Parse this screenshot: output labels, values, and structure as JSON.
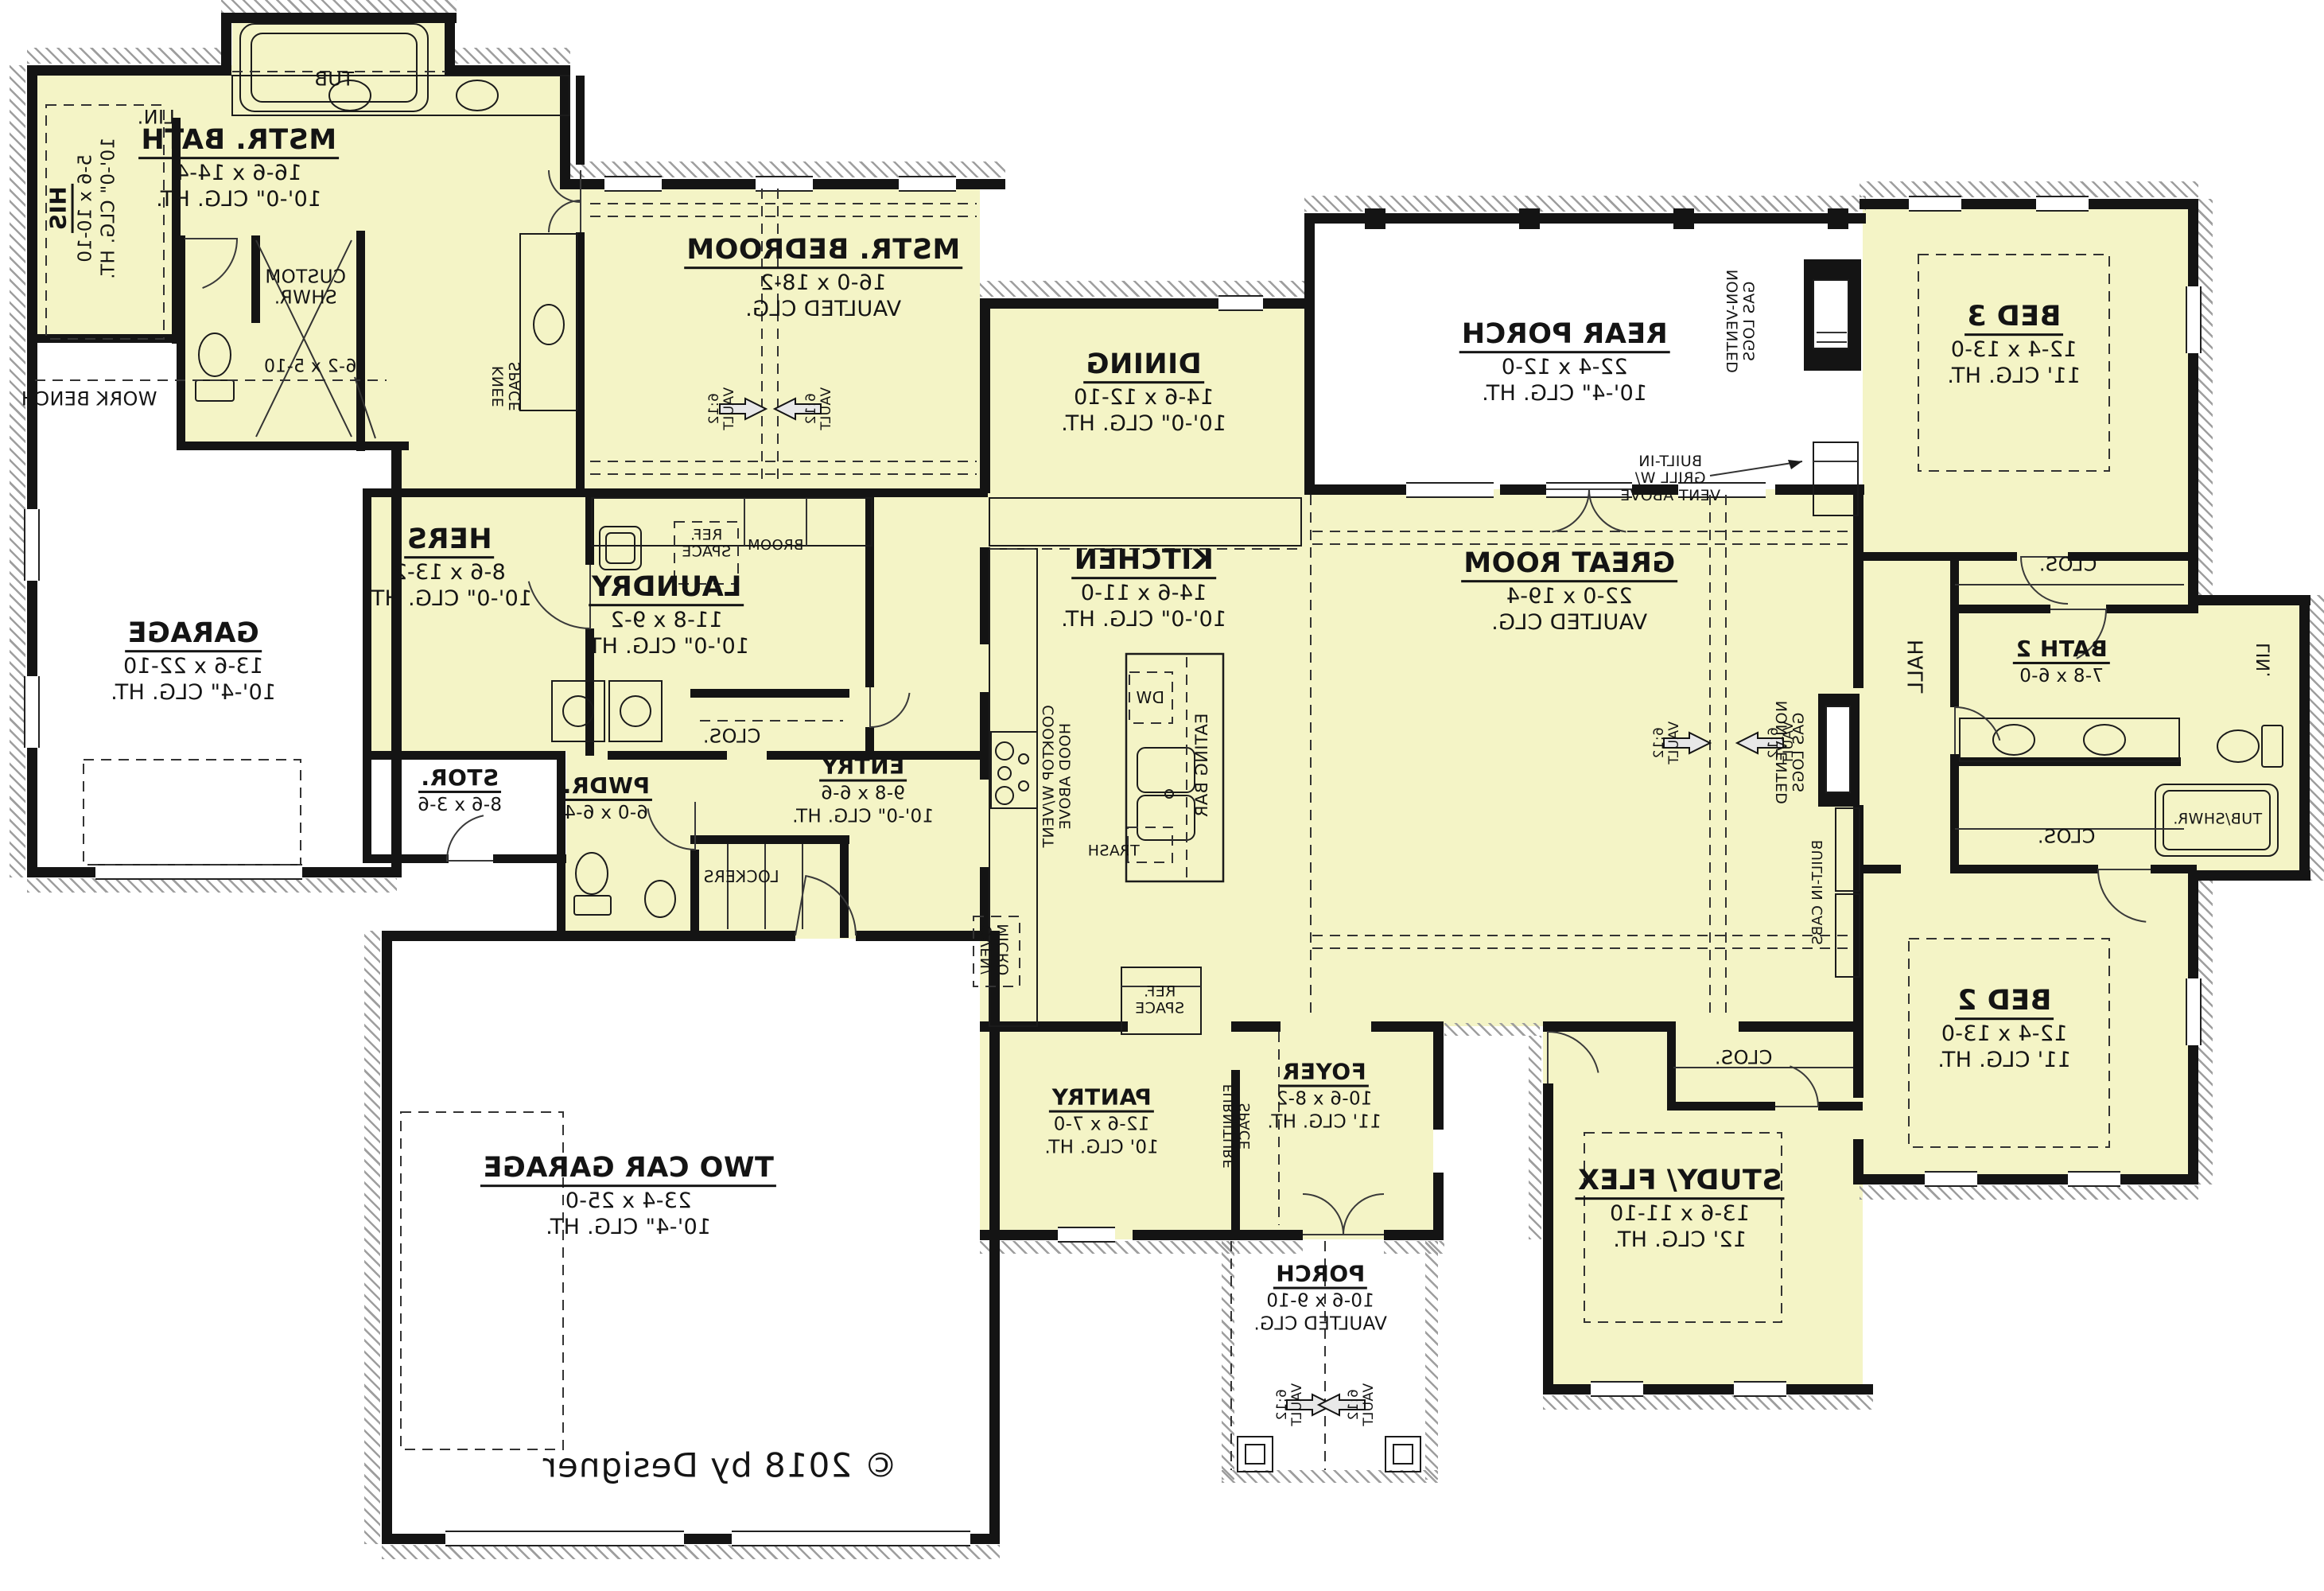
{
  "plan": {
    "copyright": "© 2018 by Designer",
    "vault_note": "6:12\nVAULT",
    "colors": {
      "room_fill": "#f4f4c6",
      "wall": "#141414",
      "hatch": "#9e9e9e",
      "paper": "#ffffff"
    },
    "rooms": [
      {
        "id": "mstr_bath",
        "label": "MSTR. BATH",
        "dims": "16-6 x 14-4",
        "clg": "10'-0\" CLG. HT."
      },
      {
        "id": "his",
        "label": "HIS",
        "dims": "5-6 x 10-10",
        "clg": "10'-0\" CLG. HT."
      },
      {
        "id": "hers",
        "label": "HERS",
        "dims": "8-6 x 13-2",
        "clg": "10'-0\" CLG. HT."
      },
      {
        "id": "mstr_bedroom",
        "label": "MSTR. BEDROOM",
        "dims": "16-0 x 18-2",
        "clg": "VAULTED CLG."
      },
      {
        "id": "laundry",
        "label": "LAUNDRY",
        "dims": "11-8 x 9-2",
        "clg": "10'-0\" CLG. HT."
      },
      {
        "id": "garage",
        "label": "GARAGE",
        "dims": "13-6 x 22-10",
        "clg": "10'-4\" CLG. HT."
      },
      {
        "id": "stor",
        "label": "STOR.",
        "dims": "8-6 x 3-6",
        "clg": ""
      },
      {
        "id": "pwdr",
        "label": "PWDR.",
        "dims": "6-0 x 6-4",
        "clg": ""
      },
      {
        "id": "entry",
        "label": "ENTRY",
        "dims": "9-8 x 6-6",
        "clg": "10'-0\" CLG. HT."
      },
      {
        "id": "dining",
        "label": "DINING",
        "dims": "14-6 x 12-10",
        "clg": "10'-0\" CLG. HT."
      },
      {
        "id": "kitchen",
        "label": "KITCHEN",
        "dims": "14-6 x 11-0",
        "clg": "10'-0\" CLG. HT."
      },
      {
        "id": "great_room",
        "label": "GREAT ROOM",
        "dims": "22-0 x 19-4",
        "clg": "VAULTED CLG."
      },
      {
        "id": "rear_porch",
        "label": "REAR PORCH",
        "dims": "22-4 x 12-0",
        "clg": "10'-4\" CLG. HT."
      },
      {
        "id": "bed3",
        "label": "BED 3",
        "dims": "12-4 x 13-0",
        "clg": "11' CLG. HT."
      },
      {
        "id": "bath2",
        "label": "BATH 2",
        "dims": "7-8 x 6-0",
        "clg": ""
      },
      {
        "id": "bed2",
        "label": "BED 2",
        "dims": "12-4 x 13-0",
        "clg": "11' CLG. HT."
      },
      {
        "id": "study",
        "label": "STUDY/ FLEX",
        "dims": "13-6 x 11-10",
        "clg": "12' CLG. HT."
      },
      {
        "id": "foyer",
        "label": "FOYER",
        "dims": "10-6 x 8-2",
        "clg": "11' CLG. HT."
      },
      {
        "id": "pantry",
        "label": "PANTRY",
        "dims": "12-6 x 7-0",
        "clg": "10' CLG. HT."
      },
      {
        "id": "porch",
        "label": "PORCH",
        "dims": "10-6 x 9-10",
        "clg": "VAULTED CLG."
      },
      {
        "id": "two_car",
        "label": "TWO CAR GARAGE",
        "dims": "23-4 x 25-0",
        "clg": "10'-4\" CLG. HT."
      }
    ],
    "annotations": [
      {
        "id": "tub",
        "text": "TUB"
      },
      {
        "id": "lin1",
        "text": "LIN."
      },
      {
        "id": "custom_shwr",
        "text": "CUSTOM\nSHWR."
      },
      {
        "id": "shwr_dims",
        "text": "6-2 x 5-10"
      },
      {
        "id": "work_bench",
        "text": "WORK BENCH"
      },
      {
        "id": "knee_space",
        "text": "KNEE\nSPACE"
      },
      {
        "id": "ref_laundry",
        "text": "REF.\nSPACE"
      },
      {
        "id": "broom",
        "text": "BROOM"
      },
      {
        "id": "clos_entry",
        "text": "CLOS."
      },
      {
        "id": "lockers",
        "text": "LOCKERS"
      },
      {
        "id": "oven_micro",
        "text": "OVEN/\nMICRO"
      },
      {
        "id": "cooktop",
        "text": "COOKTOP W/VENT\nHOOD ABOVE"
      },
      {
        "id": "dw",
        "text": "DW"
      },
      {
        "id": "eating_bar",
        "text": "EATING BAR"
      },
      {
        "id": "trash",
        "text": "TRASH"
      },
      {
        "id": "ref_kitchen",
        "text": "REF.\nSPACE"
      },
      {
        "id": "gas_logs_porch",
        "text": "NON-VENTED\nGAS LOGS"
      },
      {
        "id": "grill",
        "text": "BUILT-IN\nGRILL W/\nVENT ABOVE"
      },
      {
        "id": "gas_logs_great",
        "text": "NON-VENTED\nGAS LOGS"
      },
      {
        "id": "built_in_cabs",
        "text": "BUILT-IN CABS"
      },
      {
        "id": "hall",
        "text": "HALL"
      },
      {
        "id": "lin2",
        "text": "LIN."
      },
      {
        "id": "tub_shwr",
        "text": "TUB/SHWR."
      },
      {
        "id": "clos_bed3",
        "text": "CLOS."
      },
      {
        "id": "clos_bed2",
        "text": "CLOS."
      },
      {
        "id": "clos_study",
        "text": "CLOS."
      },
      {
        "id": "furniture",
        "text": "FURNITURE\nSPACE"
      }
    ]
  }
}
